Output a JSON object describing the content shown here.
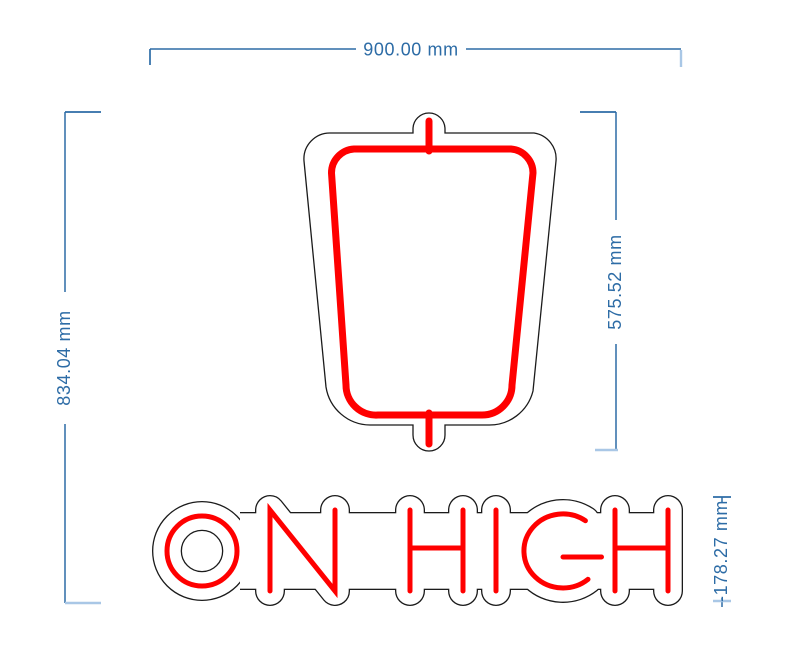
{
  "app": {
    "view": "neon-sign-dimension-preview"
  },
  "sign": {
    "text": "ON HIGH",
    "neon_color": "#ff0000",
    "backing_outline_color": "#1b1b1b",
    "background_color": "#ffffff"
  },
  "dimensions": {
    "color": "#2d6ca6",
    "tick_color_light": "#a9c7e6",
    "overall_width": "900.00 mm",
    "overall_height": "834.04 mm",
    "emblem_height": "575.52 mm",
    "text_height": "-178.27 mm"
  }
}
